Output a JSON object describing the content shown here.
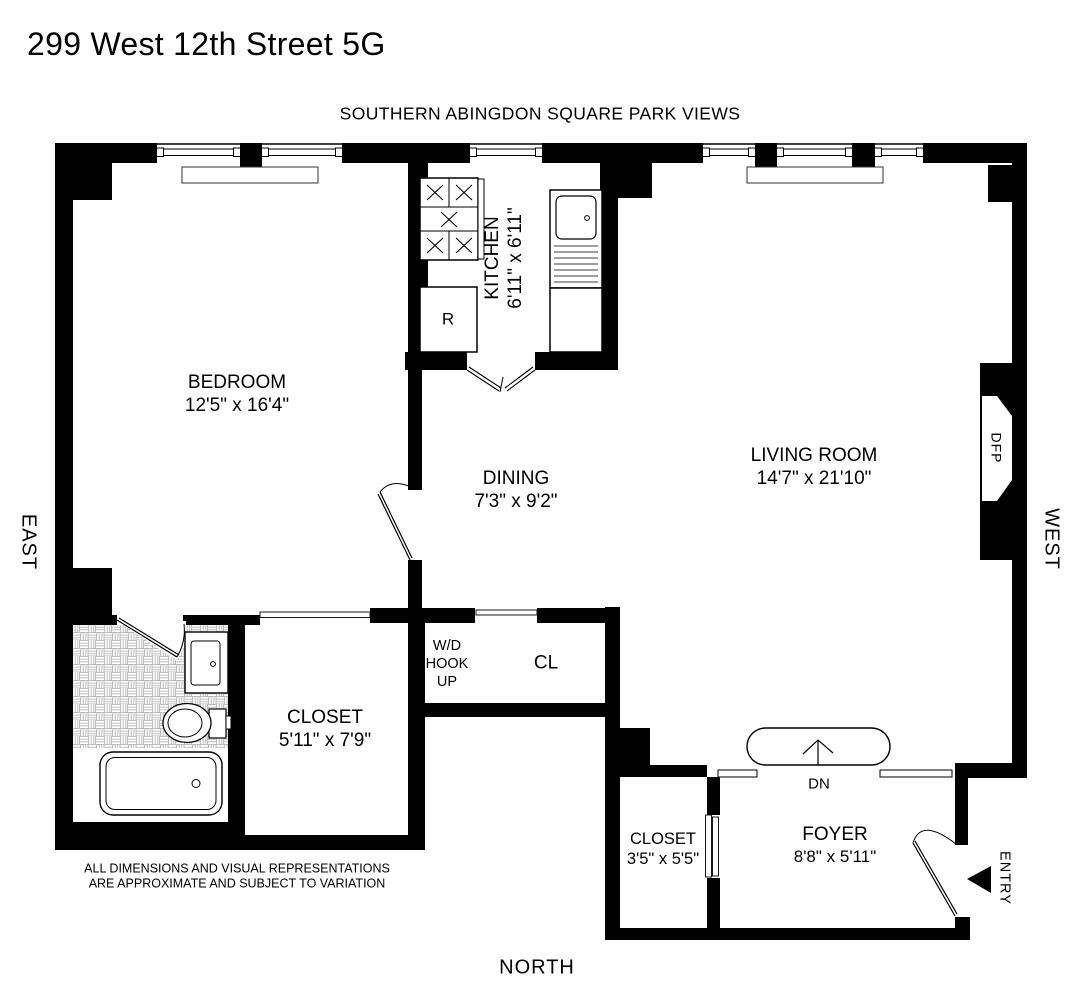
{
  "title": "299 West 12th Street 5G",
  "subtitle": "SOUTHERN ABINGDON SQUARE PARK VIEWS",
  "compass": {
    "east": "EAST",
    "west": "WEST",
    "north": "NORTH"
  },
  "disclaimer": {
    "line1": "ALL DIMENSIONS AND VISUAL REPRESENTATIONS",
    "line2": "ARE APPROXIMATE AND SUBJECT TO VARIATION"
  },
  "rooms": {
    "bedroom": {
      "name": "BEDROOM",
      "dims": "12'5\" x 16'4\""
    },
    "kitchen": {
      "name": "KITCHEN",
      "dims": "6'11\" x 6'11\""
    },
    "dining": {
      "name": "DINING",
      "dims": "7'3\" x 9'2\""
    },
    "living_room": {
      "name": "LIVING ROOM",
      "dims": "14'7\" x 21'10\""
    },
    "walk_in_closet": {
      "name": "CLOSET",
      "dims": "5'11\" x 7'9\""
    },
    "wd_hookup": {
      "line1": "W/D",
      "line2": "HOOK",
      "line3": "UP"
    },
    "cl": {
      "name": "CL"
    },
    "foyer_closet": {
      "name": "CLOSET",
      "dims": "3'5\" x 5'5\""
    },
    "foyer": {
      "name": "FOYER",
      "dims": "8'8\" x 5'11\""
    }
  },
  "annotations": {
    "down": "DN",
    "decorative_fireplace": "DFP",
    "entry": "ENTRY",
    "refrigerator": "R"
  },
  "colors": {
    "wall": "#000000",
    "background": "#ffffff",
    "tile_line": "#bdbdbd",
    "fixture_line": "#333333"
  }
}
